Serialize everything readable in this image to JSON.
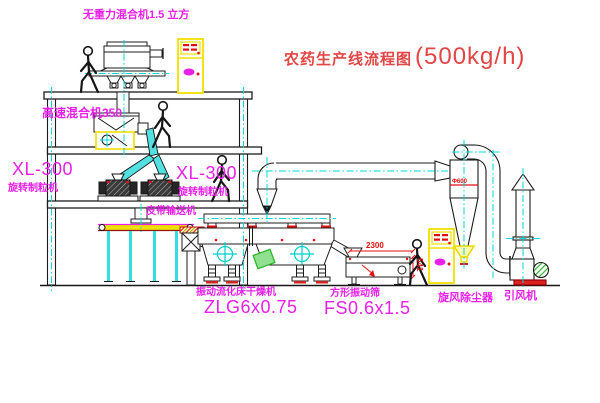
{
  "title": {
    "name": "农药生产线流程图",
    "capacity": "(500kg/h)"
  },
  "equipment_labels": {
    "gravity_mixer": "无重力混合机1.5 立方",
    "high_speed_mixer": "高速混合机350",
    "granulator_left": {
      "model": "XL-300",
      "name": "旋转制粒机"
    },
    "granulator_right": {
      "model": "XL-300",
      "name": "旋转制粒机"
    },
    "belt_conveyor": "皮带输送机",
    "fluid_bed_dryer": {
      "name": "振动流化床干燥机",
      "model": "ZLG6x0.75"
    },
    "vibrating_sieve": {
      "name": "方形振动筛",
      "model": "FS0.6x1.5"
    },
    "cyclone": "旋风除尘器",
    "fan": "引风机"
  },
  "annotations": {
    "cyclone_diameter": "Φ600",
    "sieve_width_dim": "2300",
    "sieve_height_dim": "541"
  },
  "colors": {
    "label_magenta": "#e820e8",
    "title_red": "#e34545",
    "line_black": "#1c1c1c",
    "centerline_cyan": "#00d9d9",
    "cabinet_yellow": "#f0e000",
    "dimension_red": "#e01010",
    "chute_cyan": "#52e0e0",
    "plate_green": "#2db52d"
  }
}
